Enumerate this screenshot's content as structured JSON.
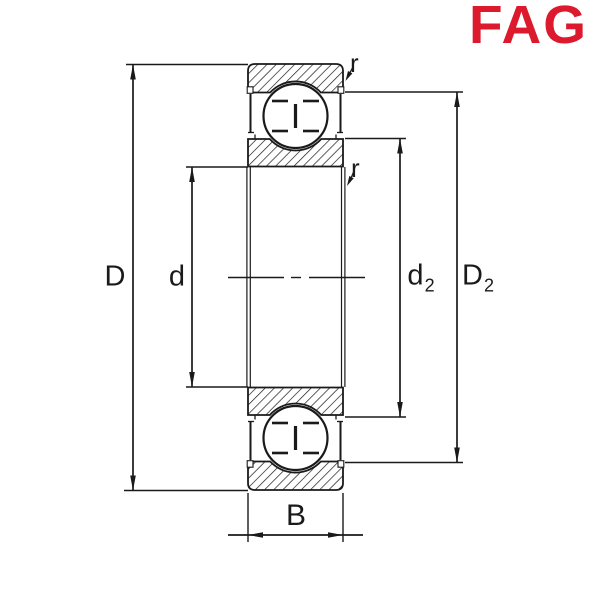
{
  "logo": {
    "text": "FAG",
    "color": "#DC192D"
  },
  "drawing": {
    "subject": "deep-groove-ball-bearing-cross-section",
    "line_color": "#1a1a1a",
    "background_color": "#ffffff"
  },
  "dimension_labels": {
    "D": "D",
    "d": "d",
    "d2": {
      "base": "d",
      "sub": "2"
    },
    "D2": {
      "base": "D",
      "sub": "2"
    },
    "B": "B",
    "r_outer": "r",
    "r_inner": "r"
  }
}
